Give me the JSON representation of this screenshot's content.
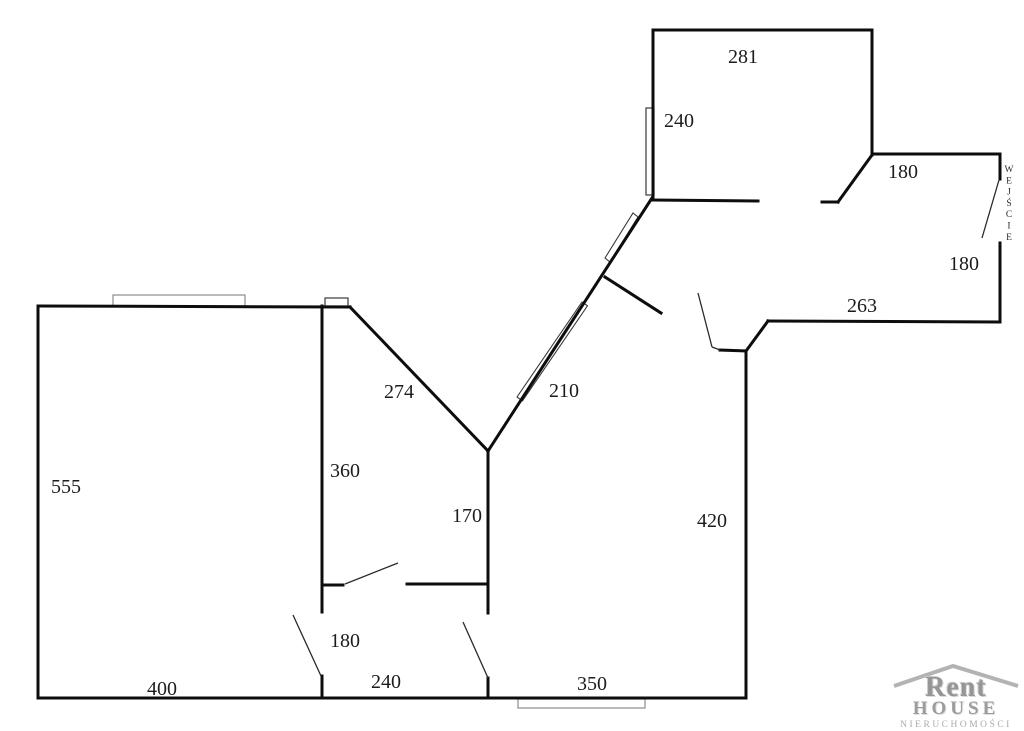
{
  "meta": {
    "background": "#ffffff",
    "wall_color": "#0d0d0d",
    "door_color": "#2a2a2a",
    "window_gray": "#8c8c8c",
    "window_dark": "#3a3a3a",
    "label_color": "#1c1c1c",
    "logo_gray": "#9c9c9c"
  },
  "floor_plan": {
    "walls": [
      [
        653,
        30,
        872,
        30
      ],
      [
        653,
        30,
        653,
        200
      ],
      [
        872,
        30,
        872,
        155
      ],
      [
        653,
        200,
        758,
        201
      ],
      [
        822,
        202,
        838,
        202
      ],
      [
        838,
        202,
        872,
        155
      ],
      [
        872,
        154,
        1000,
        154
      ],
      [
        1000,
        154,
        1000,
        179
      ],
      [
        1000,
        243,
        1000,
        322
      ],
      [
        1000,
        322,
        768,
        321
      ],
      [
        768,
        321,
        746,
        351
      ],
      [
        746,
        351,
        746,
        698
      ],
      [
        720,
        350,
        746,
        351
      ],
      [
        605,
        277,
        661,
        313
      ],
      [
        652,
        198,
        488,
        451
      ],
      [
        488,
        451,
        350,
        307
      ],
      [
        38,
        306,
        350,
        307
      ],
      [
        38,
        306,
        38,
        698
      ],
      [
        38,
        698,
        746,
        698
      ],
      [
        322,
        306,
        322,
        612
      ],
      [
        322,
        585,
        343,
        585
      ],
      [
        407,
        584,
        488,
        584
      ],
      [
        488,
        451,
        488,
        613
      ],
      [
        322,
        676,
        322,
        698
      ],
      [
        488,
        678,
        488,
        698
      ]
    ],
    "doors": [
      [
        999,
        180,
        982,
        238
      ],
      [
        698,
        293,
        712,
        347
      ],
      [
        712,
        347,
        720,
        350
      ],
      [
        345,
        584,
        398,
        563
      ],
      [
        293,
        615,
        321,
        676
      ],
      [
        463,
        622,
        488,
        678
      ]
    ],
    "windows_rect": [
      {
        "x": 113,
        "y": 295,
        "w": 132,
        "h": 11,
        "tone": "gray"
      },
      {
        "x": 325,
        "y": 298,
        "w": 23,
        "h": 8,
        "tone": "dark"
      },
      {
        "x": 646,
        "y": 108,
        "w": 8,
        "h": 87,
        "tone": "dark"
      },
      {
        "x": 518,
        "y": 699,
        "w": 127,
        "h": 9,
        "tone": "gray"
      }
    ],
    "windows_poly": [
      {
        "points": "517,397 582,302 587.5,305.8 522.5,400.8"
      },
      {
        "points": "605,258 633,213 638,217 610,262"
      }
    ],
    "dimension_labels": [
      {
        "text": "281",
        "x": 743,
        "y": 63
      },
      {
        "text": "240",
        "x": 679,
        "y": 127
      },
      {
        "text": "180",
        "x": 903,
        "y": 178
      },
      {
        "text": "180",
        "x": 964,
        "y": 270
      },
      {
        "text": "263",
        "x": 862,
        "y": 312
      },
      {
        "text": "274",
        "x": 399,
        "y": 398
      },
      {
        "text": "210",
        "x": 564,
        "y": 397
      },
      {
        "text": "360",
        "x": 345,
        "y": 477
      },
      {
        "text": "555",
        "x": 66,
        "y": 493
      },
      {
        "text": "170",
        "x": 467,
        "y": 522
      },
      {
        "text": "420",
        "x": 712,
        "y": 527
      },
      {
        "text": "180",
        "x": 345,
        "y": 647
      },
      {
        "text": "400",
        "x": 162,
        "y": 695
      },
      {
        "text": "240",
        "x": 386,
        "y": 688
      },
      {
        "text": "350",
        "x": 592,
        "y": 690
      }
    ],
    "entrance": {
      "text": "WEJŚCIE",
      "x": 1009,
      "y_start": 172,
      "step": 11.3
    }
  },
  "logo": {
    "brand_top": "Rent",
    "brand_bottom": "HOUSE",
    "tagline": "NIERUCHOMOŚCI"
  }
}
